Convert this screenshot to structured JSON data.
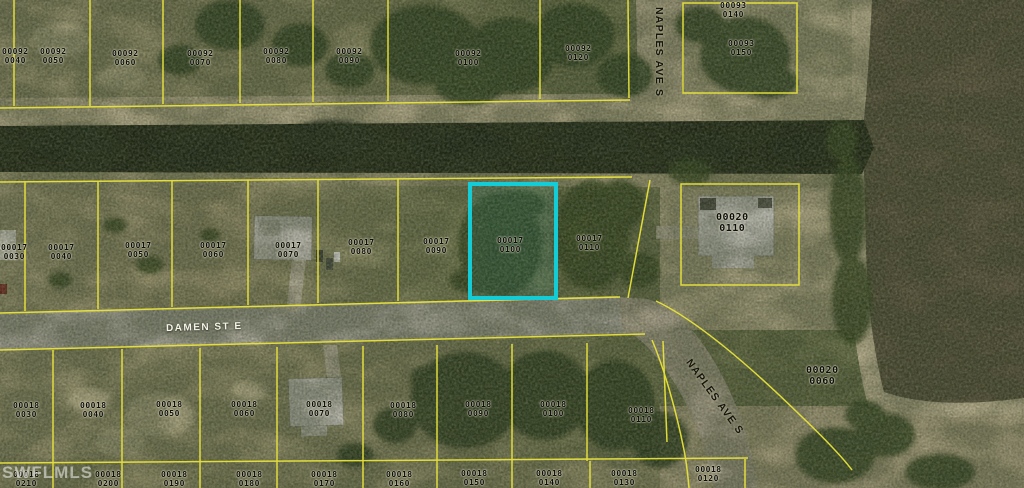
{
  "map": {
    "watermark": "SWFLMLS",
    "streets": {
      "damen": "DAMEN ST E",
      "naples_top": "NAPLES AVE S",
      "naples_bottom": "NAPLES AVE S"
    },
    "highlight": {
      "parcel": "00017 0100",
      "color": "#14ccd6"
    },
    "colors": {
      "boundary_yellow": "#e8e33a",
      "canal_water": "#1f2715",
      "pond_water": "#59533d",
      "road_gray": "#a9a79a"
    }
  },
  "parcels": [
    {
      "block": "00092",
      "lot": "0040"
    },
    {
      "block": "00092",
      "lot": "0050"
    },
    {
      "block": "00092",
      "lot": "0060"
    },
    {
      "block": "00092",
      "lot": "0070"
    },
    {
      "block": "00092",
      "lot": "0080"
    },
    {
      "block": "00092",
      "lot": "0090"
    },
    {
      "block": "00092",
      "lot": "0100"
    },
    {
      "block": "00092",
      "lot": "0120"
    },
    {
      "block": "00093",
      "lot": "0140"
    },
    {
      "block": "00093",
      "lot": "0150"
    },
    {
      "block": "00017",
      "lot": "0030"
    },
    {
      "block": "00017",
      "lot": "0040"
    },
    {
      "block": "00017",
      "lot": "0050"
    },
    {
      "block": "00017",
      "lot": "0060"
    },
    {
      "block": "00017",
      "lot": "0070"
    },
    {
      "block": "00017",
      "lot": "0080"
    },
    {
      "block": "00017",
      "lot": "0090"
    },
    {
      "block": "00017",
      "lot": "0100"
    },
    {
      "block": "00017",
      "lot": "0110"
    },
    {
      "block": "00020",
      "lot": "0110"
    },
    {
      "block": "00018",
      "lot": "0030"
    },
    {
      "block": "00018",
      "lot": "0040"
    },
    {
      "block": "00018",
      "lot": "0050"
    },
    {
      "block": "00018",
      "lot": "0060"
    },
    {
      "block": "00018",
      "lot": "0070"
    },
    {
      "block": "00018",
      "lot": "0080"
    },
    {
      "block": "00018",
      "lot": "0090"
    },
    {
      "block": "00018",
      "lot": "0100"
    },
    {
      "block": "00018",
      "lot": "0110"
    },
    {
      "block": "00018",
      "lot": "0210"
    },
    {
      "block": "00018",
      "lot": "0200"
    },
    {
      "block": "00018",
      "lot": "0190"
    },
    {
      "block": "00018",
      "lot": "0180"
    },
    {
      "block": "00018",
      "lot": "0170"
    },
    {
      "block": "00018",
      "lot": "0160"
    },
    {
      "block": "00018",
      "lot": "0150"
    },
    {
      "block": "00018",
      "lot": "0140"
    },
    {
      "block": "00018",
      "lot": "0130"
    },
    {
      "block": "00018",
      "lot": "0120"
    },
    {
      "block": "00020",
      "lot": "0060"
    }
  ]
}
